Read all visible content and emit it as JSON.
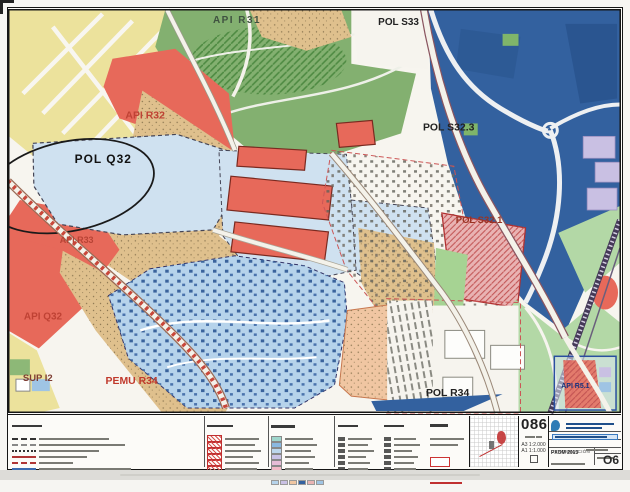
{
  "map": {
    "labels": {
      "api_r31": "API R31",
      "pol_s33": "POL S33",
      "api_r32": "API R32",
      "pol_s32_3": "POL S32.3",
      "pol_q32": "POL Q32",
      "api_r33": "API R33",
      "pol_s32_1": "POL S32.1",
      "api_q32": "API Q32",
      "sup_i2": "SUP I2",
      "pemu_r34": "PEMU R34",
      "pol_r34": "POL R34",
      "api_r5_1": "API R5.1"
    }
  },
  "colors": {
    "residential_yellow": "#ece29c",
    "park_green": "#83b070",
    "light_green": "#b3d8a6",
    "urban_red": "#e7695a",
    "old_town_tan": "#dfc08d",
    "plan_blue_light": "#cfe1f0",
    "pemu_blue": "#b6d3eb",
    "industrial_blue": "#33619f",
    "pink_zone": "#e9b3b3",
    "lilac_zone": "#c9c0e3",
    "salmon_zone": "#f0c6a2",
    "white_parcel": "#f6f4ee"
  },
  "legend": {
    "hatch_color": "#d9534f",
    "outline_color": "#cc3333",
    "ordinance_swatches": [
      "#9fd6cc",
      "#8ab8e0",
      "#bcd6ec",
      "#c9c2e6",
      "#e6bcd6",
      "#f2b9c6"
    ],
    "landuse_grid": [
      "#8db877",
      "#b3d8a6",
      "#dfc08d",
      "#ece29c",
      "#e7695a",
      "#cfe1f0",
      "#b6d3eb",
      "#c9c0e3",
      "#f0c6a2",
      "#33619f",
      "#e9b3b3",
      "#9fc4e4"
    ]
  },
  "titleblock": {
    "sheet_number": "086",
    "series_code": "O6",
    "plan_name": "PXOM 2013",
    "denomination_label": "DENOMINACIÓN",
    "scale_a3": "A3 1:2.000",
    "scale_a1": "A1 1:1.000"
  }
}
